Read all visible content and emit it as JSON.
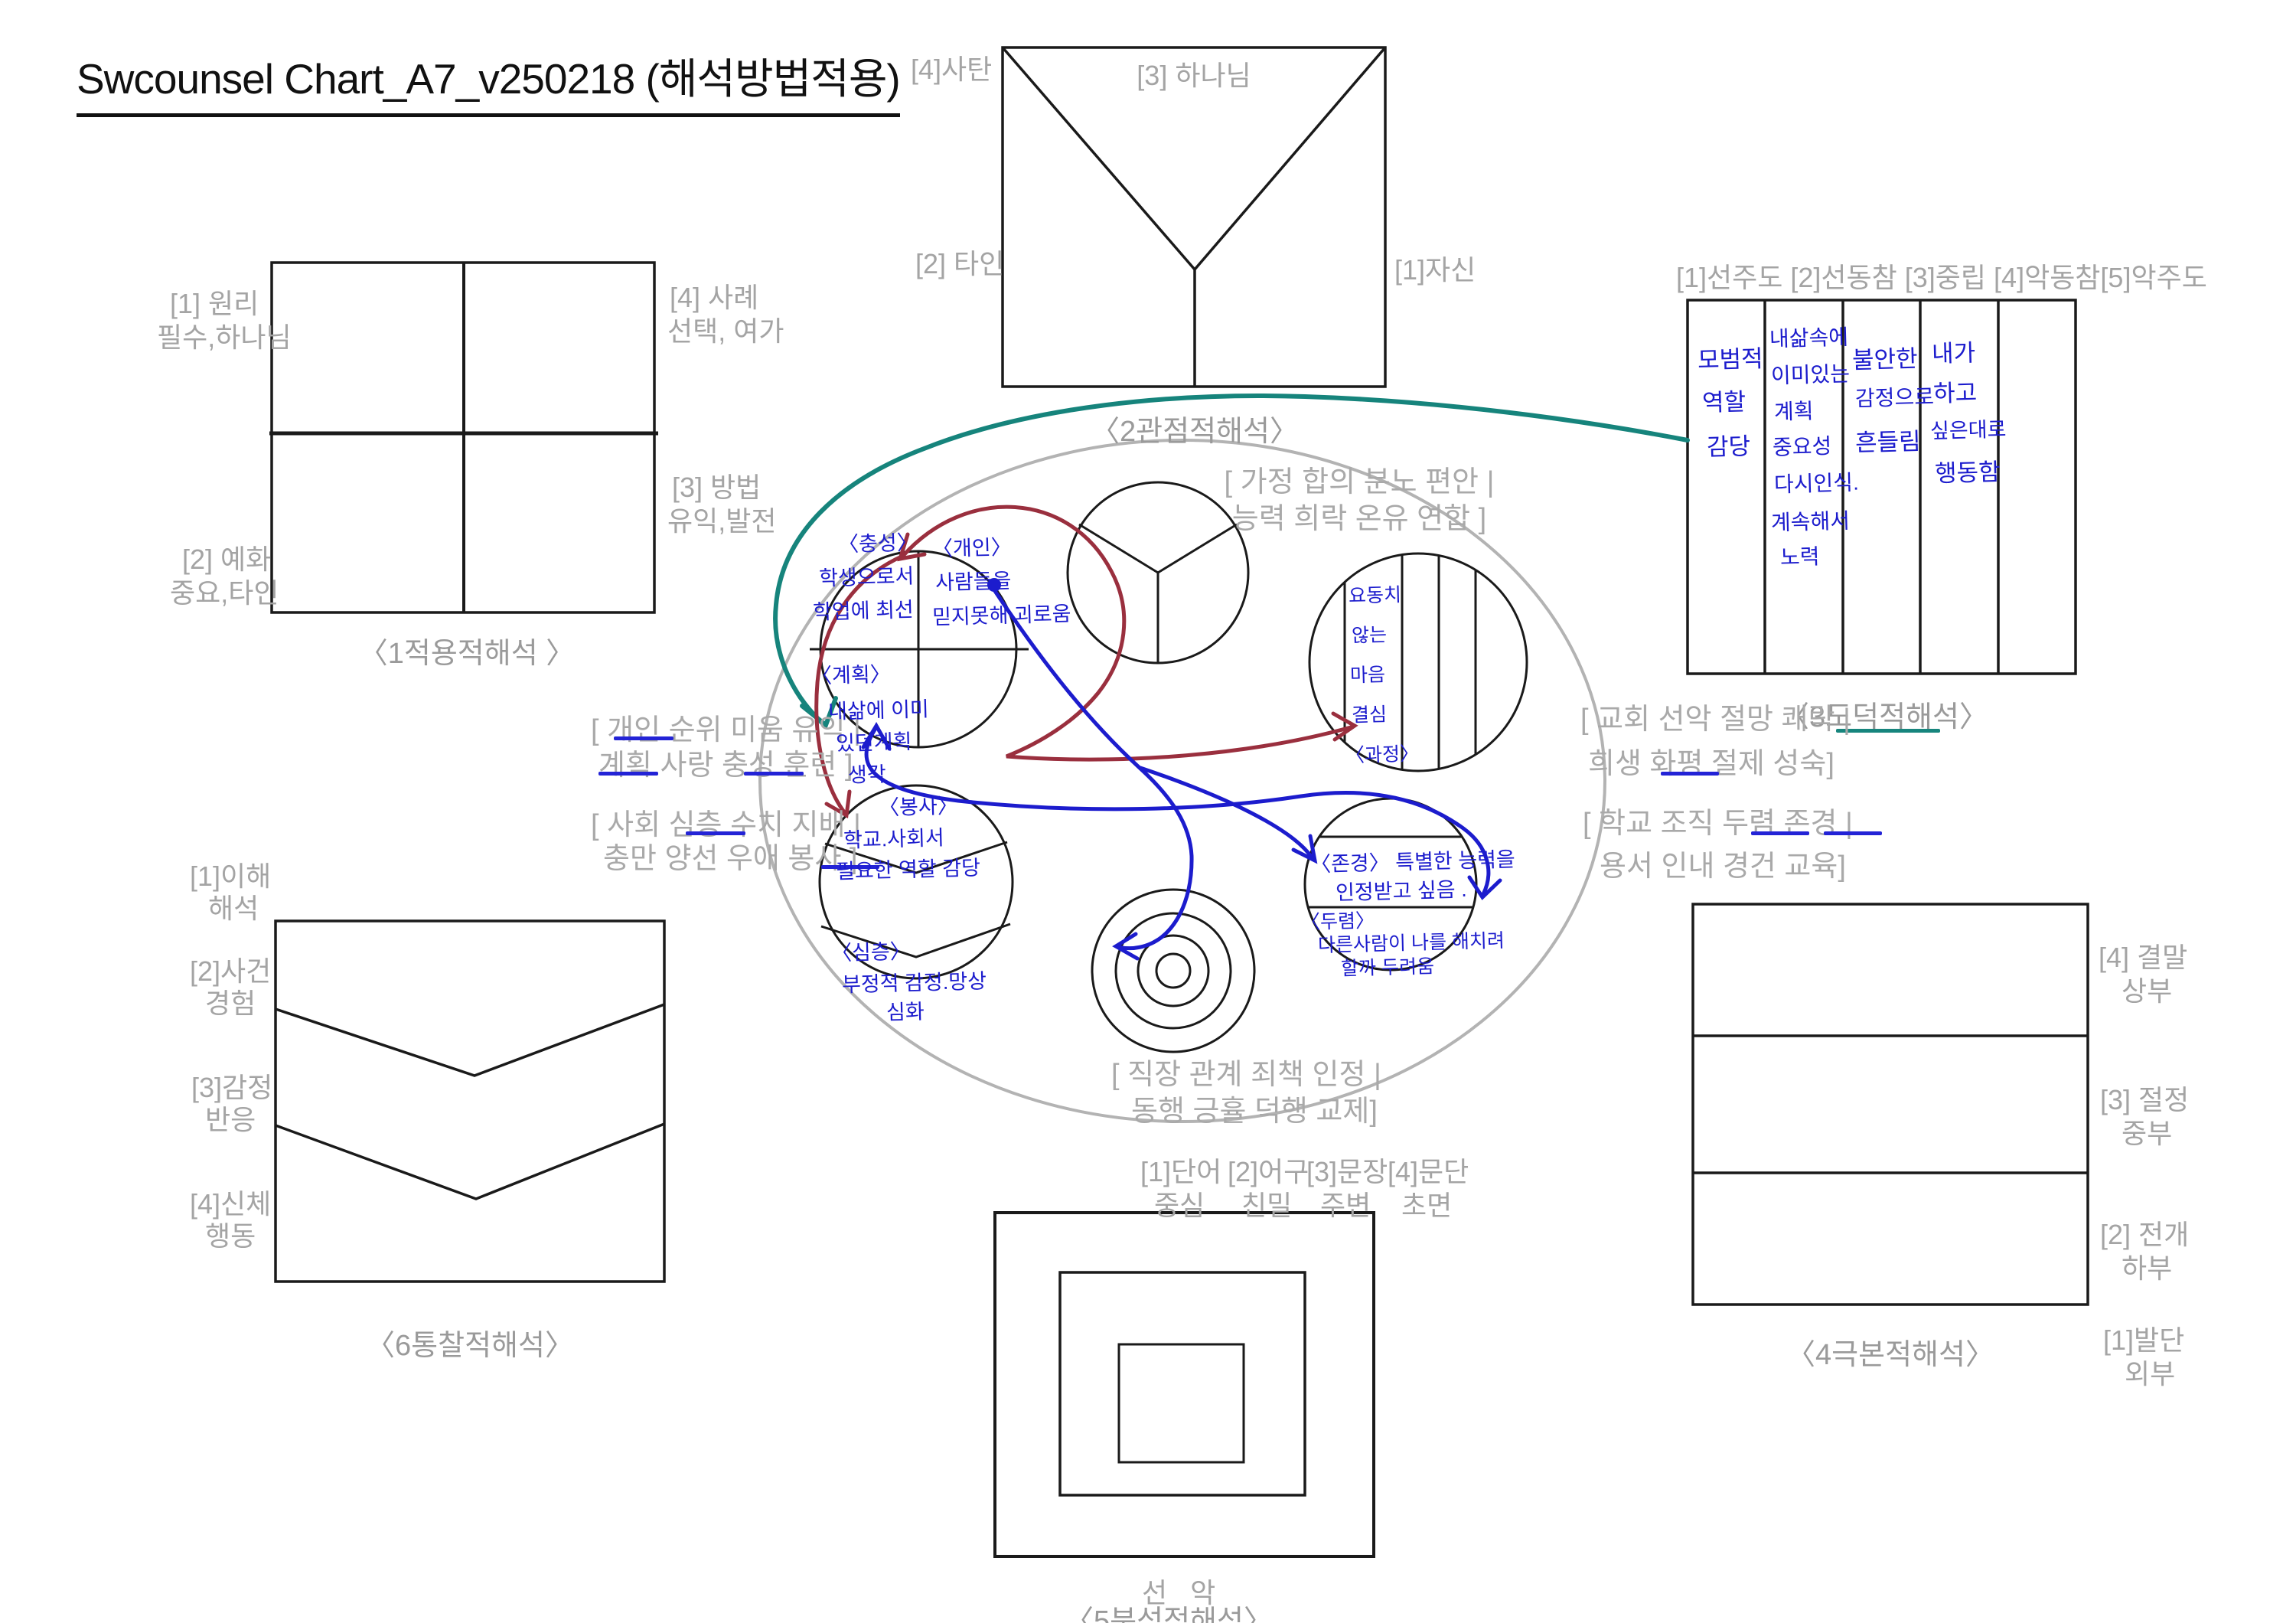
{
  "title": "Swcounsel Chart_A7_v250218 (해석방법적용)",
  "d1": {
    "caption": "〈1적용적해석 〉",
    "q1a": "[1] 원리",
    "q1b": "필수,하나님",
    "q4a": "[4] 사례",
    "q4b": "선택, 여가",
    "q3a": "[3] 방법",
    "q3b": "유익,발전",
    "q2a": "[2] 예화",
    "q2b": "중요,타인"
  },
  "d2": {
    "caption": "〈2관점적해석〉",
    "satan": "[4]사탄",
    "god": "[3] 하나님",
    "others": "[2] 타인",
    "self": "[1]자신"
  },
  "d3": {
    "caption": "〈3도덕적해석〉",
    "header": "[1]선주도 [2]선동참 [3]중립 [4]악동참[5]악주도",
    "col1": [
      "모범적",
      "역할",
      "감당"
    ],
    "col2": [
      "내삶속에",
      "이미있는",
      "계획",
      "중요성",
      "다시인식.",
      "계속해서",
      "노력"
    ],
    "col3": [
      "불안한",
      "감정으로",
      "흔들림"
    ],
    "col4": [
      "내가",
      "하고",
      "싶은대로",
      "행동함"
    ]
  },
  "d4": {
    "caption": "〈4극본적해석〉",
    "r4a": "[4] 결말",
    "r4b": "상부",
    "r3a": "[3] 절정",
    "r3b": "중부",
    "r2a": "[2] 전개",
    "r2b": "하부",
    "r1a": "[1]발단",
    "r1b": "외부"
  },
  "d5": {
    "caption": "〈5분석적해석〉",
    "w1": "[1]단어",
    "w2": "[2]어구",
    "w3": "[3]문장",
    "w4": "[4]문단",
    "s1": "중심",
    "s2": "친밀",
    "s3": "주변",
    "s4": "초면",
    "goodevil": "선   악"
  },
  "d6": {
    "caption": "〈6통찰적해석〉",
    "l1a": "[1]이해",
    "l1b": "해석",
    "l2a": "[2]사건",
    "l2b": "경험",
    "l3a": "[3]감정",
    "l3b": "반응",
    "l4a": "[4]신체",
    "l4b": "행동"
  },
  "ellipse": {
    "top1": "[ 가정 합의 분노 편안 |",
    "top2": "능력 희락 온유 연합 ]",
    "left1": "[ 개인 순위 미움 유익 |",
    "left2": "계획 사랑 충성 훈련 ]",
    "left3": "[ 사회 심층 수치  지배 |",
    "left4": "충만 양선 우애 봉사 ]",
    "right1": "[ 교회 선악 절망 쾌락 |",
    "right2": "희생 화평 절제 성숙]",
    "right3": "[ 학교 조직 두렴 존경 |",
    "right4": "용서 인내 경건 교육]",
    "bottom1": "[ 직장 관계 죄책 인정 |",
    "bottom2": "동행 긍휼 덕행 교제]",
    "cB_tl": [
      "〈충성〉",
      "학생으로서",
      "학업에 최선"
    ],
    "cB_tr": [
      "〈개인〉",
      "사람들을",
      "믿지못해 괴로움"
    ],
    "cB_bl": [
      "〈계획〉",
      "내삶에 이미",
      "있던계획",
      "생각"
    ],
    "cC_top": [
      "〈봉사〉",
      "학교.사회서",
      "필요한 역할 감당"
    ],
    "cC_bot": [
      "〈심층〉",
      "부정적 감정.망상",
      "심화"
    ],
    "cD": [
      "요동치",
      "않는",
      "마음",
      "결심",
      "〈과정〉"
    ],
    "cE_mid": [
      "〈존경〉 특별한 능력을",
      "인정받고 싶음 ."
    ],
    "cE_bot": [
      "〈두렴〉",
      "다른사람이 나를 해치려",
      "할까 두려움"
    ]
  }
}
